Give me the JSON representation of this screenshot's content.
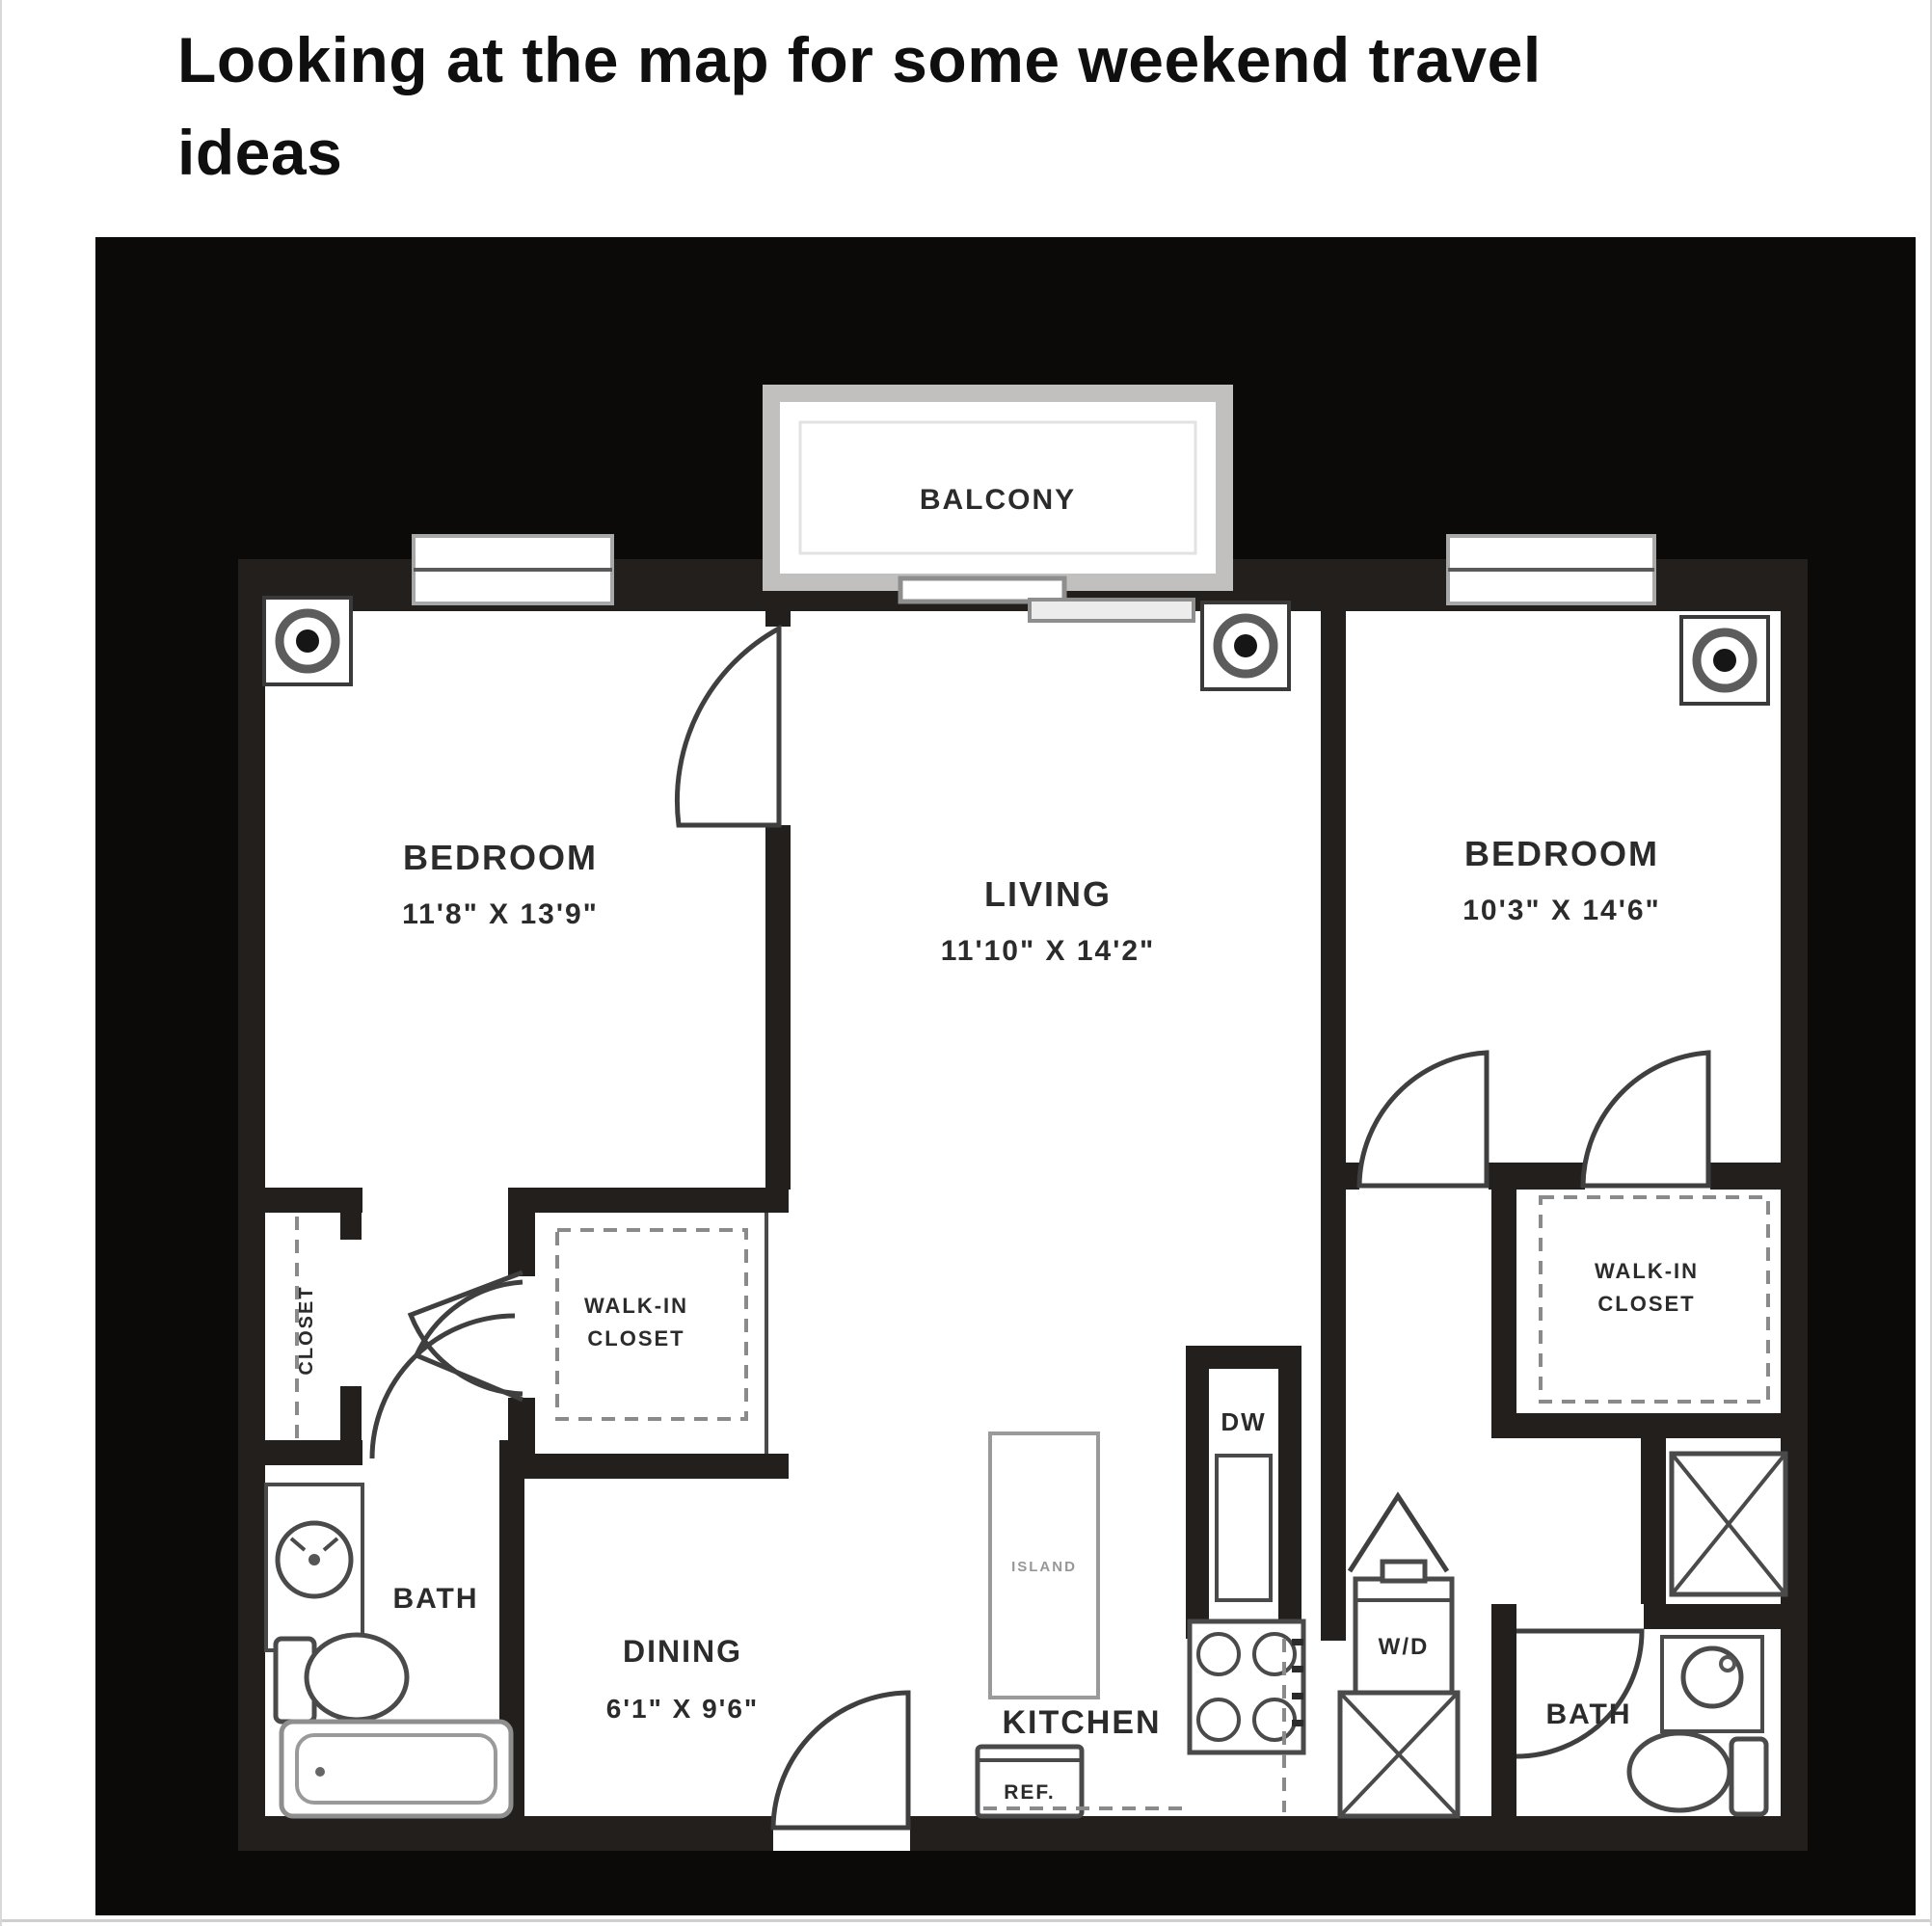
{
  "post": {
    "caption": "Looking at the map for some weekend travel ideas"
  },
  "floorplan": {
    "colors": {
      "plan_background": "#0b0a09",
      "wall": "#221f1c",
      "balcony_border": "#c2c0be"
    },
    "labels": {
      "balcony": "BALCONY",
      "bedroom1": "BEDROOM",
      "bedroom1_dims": "11'8\" X 13'9\"",
      "living": "LIVING",
      "living_dims": "11'10\" X 14'2\"",
      "bedroom2": "BEDROOM",
      "bedroom2_dims": "10'3\" X 14'6\"",
      "wic_left_line1": "WALK-IN",
      "wic_left_line2": "CLOSET",
      "wic_right_line1": "WALK-IN",
      "wic_right_line2": "CLOSET",
      "closet": "CLOSET",
      "bath_left": "BATH",
      "bath_right": "BATH",
      "dining": "DINING",
      "dining_dims": "6'1\" X 9'6\"",
      "kitchen": "KITCHEN",
      "dishwasher": "DW",
      "washer_dryer": "W/D",
      "refrigerator": "REF.",
      "island": "ISLAND"
    }
  }
}
